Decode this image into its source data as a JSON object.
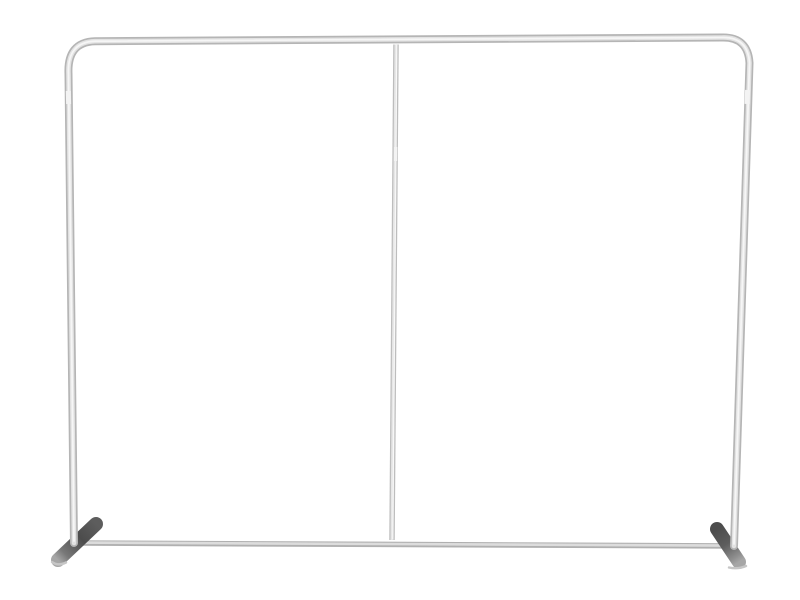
{
  "image": {
    "alt": "Silver aluminum tube backdrop display frame with rounded top corners, a center support pole, a bottom crossbar and two flat angled stabilizer feet, photographed on a plain white background"
  },
  "colors": {
    "background": "#ffffff",
    "tube-base": "#b5b5b5",
    "tube-mid": "#e3e3e3",
    "tube-highlight": "#f6f6f6",
    "bar-base": "#b0b0b0",
    "bar-mid": "#dcdcdc",
    "pole-base": "#bdbdbd",
    "pole-mid": "#e7e7e7",
    "pole-highlight": "#f8f8f8",
    "joint": "#f3f3f3",
    "foot-dark": "#4c4c4c",
    "foot-mid": "#5d5d5d",
    "foot-light": "#a6a6a6",
    "foot-rim": "#c6c6c6"
  },
  "parts": {
    "frame_tube": "outer frame tube with rounded top corners",
    "center_pole": "vertical center support pole",
    "bottom_bar": "bottom crossbar",
    "left_foot": "left stabilizer foot",
    "right_foot": "right stabilizer foot",
    "joints": "tube segment connector seams"
  }
}
